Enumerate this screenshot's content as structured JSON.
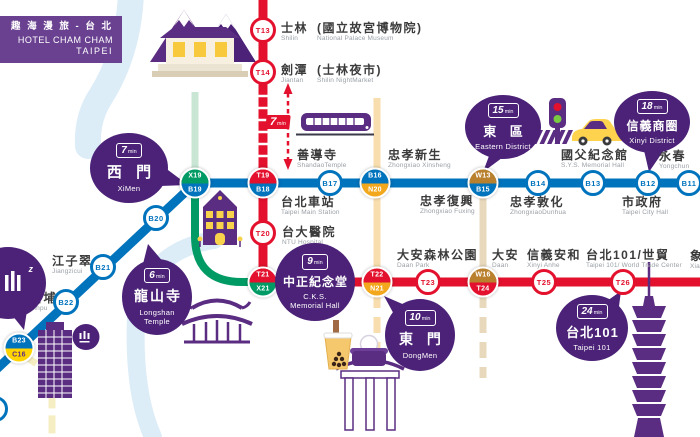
{
  "brand": {
    "zh": "趣 海 漫 旅 - 台 北",
    "hotel": "HOTEL CHAM CHAM",
    "city": "TAIPEI"
  },
  "units": {
    "min": "min"
  },
  "transfer_chip": {
    "value": "7"
  },
  "badges": {
    "t13": "T13",
    "t14": "T14",
    "t20": "T20",
    "t23": "T23",
    "t25": "T25",
    "t26": "T26",
    "b17": "B17",
    "b14": "B14",
    "b13": "B13",
    "b12": "B12",
    "b11": "B11",
    "b20": "B20",
    "b21": "B21",
    "b22": "B22",
    "x19": "X19",
    "b19": "B19",
    "t19": "T19",
    "b18": "B18",
    "b16": "B16",
    "n20": "N20",
    "w13": "W13",
    "b15": "B15",
    "t21": "T21",
    "x21": "X21",
    "t22": "T22",
    "n21": "N21",
    "w16": "W16",
    "t24": "T24",
    "b23": "B23",
    "c16": "C16"
  },
  "labels": {
    "shilin": {
      "zh": "士林",
      "paren": "(國立故宮博物院)",
      "en": "Shilin",
      "paren_en": "National Palace Museum"
    },
    "jiantan": {
      "zh": "劍潭",
      "paren": "(士林夜市)",
      "en": "Jiantan",
      "paren_en": "Shilin NightMarket"
    },
    "shandao": {
      "zh": "善導寺",
      "en": "ShandaoTemple"
    },
    "main_station": {
      "zh": "台北車站",
      "en": "Taipei Main Station"
    },
    "ntu": {
      "zh": "台大醫院",
      "en": "NTU Hospital"
    },
    "xinsheng": {
      "zh": "忠孝新生",
      "en": "Zhongxiao Xinsheng"
    },
    "fuxing": {
      "zh": "忠孝復興",
      "en": "Zhongxiao Fuxing"
    },
    "dunhua": {
      "zh": "忠孝敦化",
      "en": "ZhongxiaoDunhua"
    },
    "sys": {
      "zh": "國父紀念館",
      "en": "S.Y.S. Memorial Hall"
    },
    "cityhall": {
      "zh": "市政府",
      "en": "Taipei City Hall"
    },
    "yongchun": {
      "zh": "永春",
      "en": "Yongchun"
    },
    "jiangzicui": {
      "zh": "江子翠",
      "en": "Jiangzicui"
    },
    "xinpu": {
      "zh": "新埔",
      "en": "Xinpu"
    },
    "daanpark": {
      "zh": "大安森林公園",
      "en": "Daan Park"
    },
    "daan": {
      "zh": "大安",
      "en": "Daan"
    },
    "anhe": {
      "zh": "信義安和",
      "en": "Xinyi Anhe"
    },
    "wtc": {
      "zh": "台北101/世貿",
      "en": "Taipei 101/ World Trade Center"
    },
    "xiangshan": {
      "zh": "象山",
      "en": "Xiangshan"
    }
  },
  "bubbles": {
    "ximen": {
      "min": "7",
      "zh": "西 門",
      "en": "XiMen"
    },
    "longshan": {
      "min": "6",
      "zh": "龍山寺",
      "en1": "Longshan",
      "en2": "Temple"
    },
    "cks": {
      "min": "9",
      "zh": "中正紀念堂",
      "en1": "C.K.S.",
      "en2": "Memorial Hall"
    },
    "dongmen": {
      "min": "10",
      "zh": "東 門",
      "en": "DongMen"
    },
    "eastern": {
      "min": "15",
      "zh": "東 區",
      "en": "Eastern District"
    },
    "xinyi": {
      "min": "18",
      "zh": "信義商圈",
      "en": "Xinyi District"
    },
    "t101": {
      "min": "24",
      "zh": "台北101",
      "en": "Taipei 101"
    }
  },
  "hotel": {
    "sleep": "z"
  },
  "colors": {
    "brand_purple": "#6a4191",
    "bubble_purple": "#4b2277",
    "illustration_purple": "#5b2d82",
    "red_line": "#e3112d",
    "blue_line": "#0073bd",
    "green_line": "#009b65",
    "orange_line": "#f2a71d",
    "brown_line": "#b9802e",
    "yellow_line": "#ffd400",
    "river_blue": "#dcedf8",
    "label_gray": "#9aa0a6"
  },
  "icons": [
    "train-icon",
    "taxi-icon",
    "traffic-light-icon",
    "zebra-crossing-icon",
    "bubble-tea-icon",
    "steamer-basket-icon",
    "mountain-museum-illustration",
    "red-house-illustration",
    "temple-illustration",
    "memorial-gate-illustration",
    "hotel-building-illustration",
    "taipei-101-illustration",
    "hotel-logo-icon"
  ]
}
